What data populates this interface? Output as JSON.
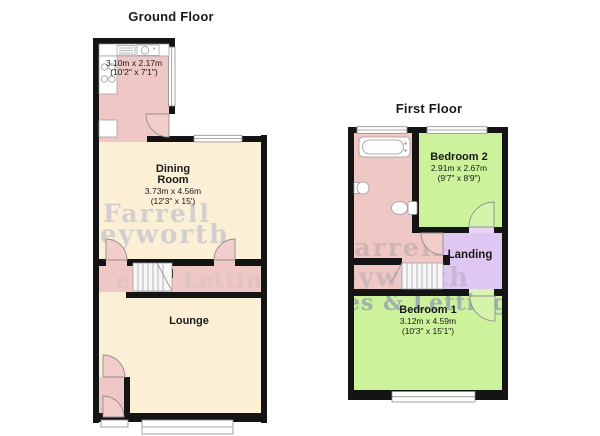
{
  "ground_floor": {
    "title": "Ground Floor",
    "kitchen": {
      "dims_m": "3.10m x 2.17m",
      "dims_ft": "(10'2\" x 7'1\")"
    },
    "dining_room": {
      "name_line1": "Dining",
      "name_line2": "Room",
      "dims_m": "3.73m x 4.56m",
      "dims_ft": "(12'3\" x 15')"
    },
    "lounge": {
      "name": "Lounge"
    }
  },
  "first_floor": {
    "title": "First Floor",
    "bedroom2": {
      "name": "Bedroom 2",
      "dims_m": "2.91m x 2.67m",
      "dims_ft": "(9'7\" x 8'9\")"
    },
    "landing": {
      "name": "Landing"
    },
    "bedroom1": {
      "name": "Bedroom 1",
      "dims_m": "3.12m x 4.59m",
      "dims_ft": "(10'3\" x 15'1\")"
    }
  },
  "watermark": {
    "line1": "Farrell",
    "line2": "eyworth",
    "line3": "es & Lettings"
  },
  "colors": {
    "room_pink": "#efc7c4",
    "room_cream": "#fbf0d5",
    "room_green": "#ccf29b",
    "room_purple": "#dfc7f3",
    "wall_black": "#141414"
  }
}
